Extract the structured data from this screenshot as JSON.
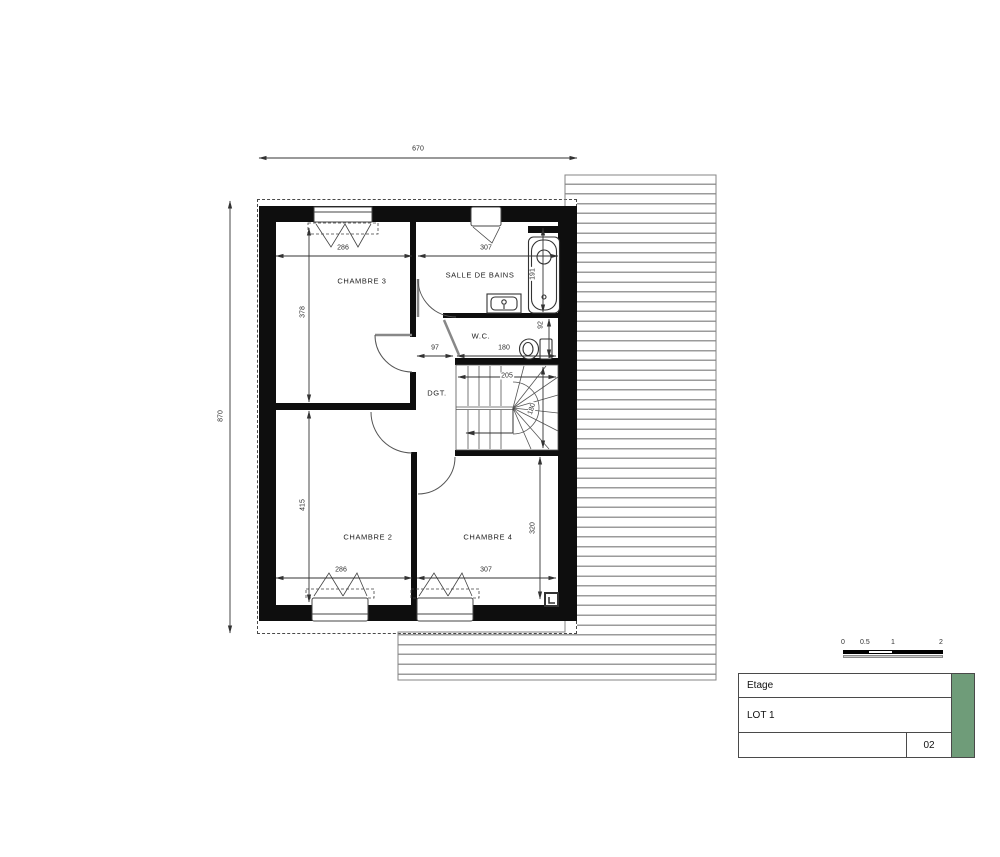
{
  "plan": {
    "rooms": {
      "chambre3": "CHAMBRE 3",
      "salle_de_bains": "SALLE DE BAINS",
      "wc": "W.C.",
      "dgt": "DGT.",
      "chambre2": "CHAMBRE 2",
      "chambre4": "CHAMBRE 4"
    },
    "dimensions": {
      "overall_width": "670",
      "overall_height": "870",
      "top_left": "286",
      "top_right": "307",
      "chambre3_depth": "378",
      "bath_depth": "191",
      "landing": "97",
      "wc_width": "180",
      "wc_depth": "92",
      "stairs_width": "205",
      "stairs_depth": "180",
      "chambre2_depth": "415",
      "chambre4_depth": "320",
      "bottom_left": "286",
      "bottom_right": "307"
    }
  },
  "scale_bar": {
    "t0": "0",
    "t05": "0.5",
    "t1": "1",
    "t2": "2"
  },
  "title_block": {
    "level": "Etage",
    "lot": "LOT 1",
    "sheet": "02"
  },
  "colors": {
    "accent_green": "#6f9c79",
    "wall": "#0e0e0e",
    "hatch_line": "#9b9b9b"
  }
}
